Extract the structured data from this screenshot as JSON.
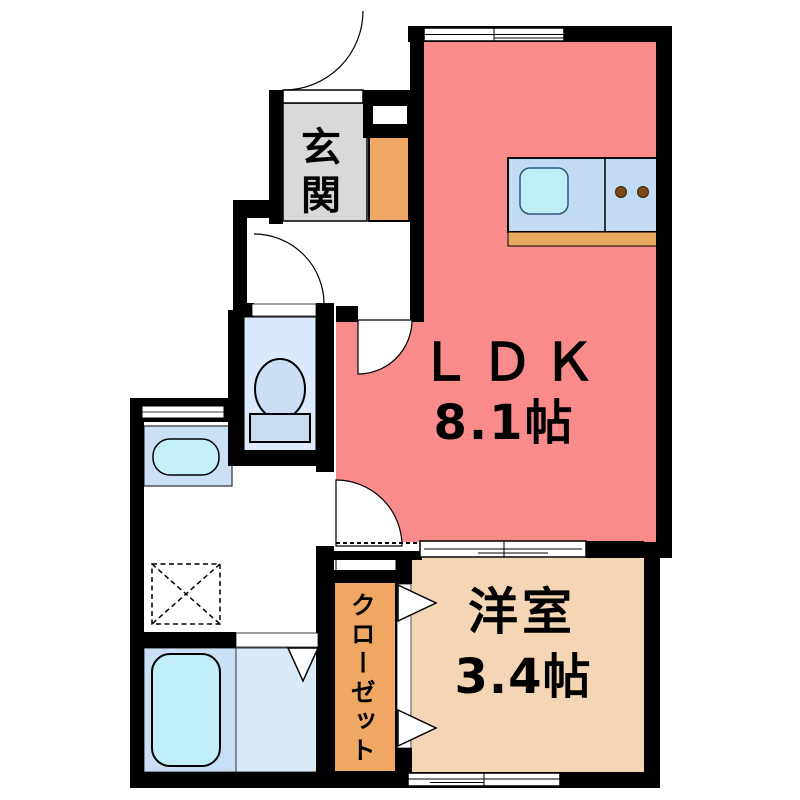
{
  "floor_plan": {
    "rooms": {
      "ldk": {
        "label": "ＬＤＫ",
        "area": "8.1帖",
        "color": "#f98b8b"
      },
      "western_room": {
        "label": "洋室",
        "area": "3.4帖",
        "color": "#f4d5b4"
      },
      "entrance": {
        "label": "玄関",
        "color": "#d9d9d9"
      },
      "closet": {
        "label": "クローゼット",
        "color": "#f0a763"
      },
      "shoe_cabinet": {
        "color": "#f0a763"
      }
    },
    "fixtures": {
      "kitchen": {
        "counter_color": "#c2daf2",
        "sink_color": "#bfeef6",
        "base_color": "#e8a85f",
        "burner_color": "#7a4b17",
        "burner_count": 2
      },
      "toilet": {
        "floor_color": "#dce9fa",
        "fixture_color": "#cbddf3"
      },
      "washbasin": {
        "cabinet_color": "#cce0f5",
        "bowl_color": "#c3eff8"
      },
      "bath": {
        "surround_color": "#c9dff5",
        "floor_color": "#dbeaf9",
        "tub_color": "#bfeef8"
      },
      "washer_space": {
        "symbol": "dashed-box-with-x"
      }
    },
    "wall_color": "#000000",
    "background_color": "#ffffff"
  }
}
